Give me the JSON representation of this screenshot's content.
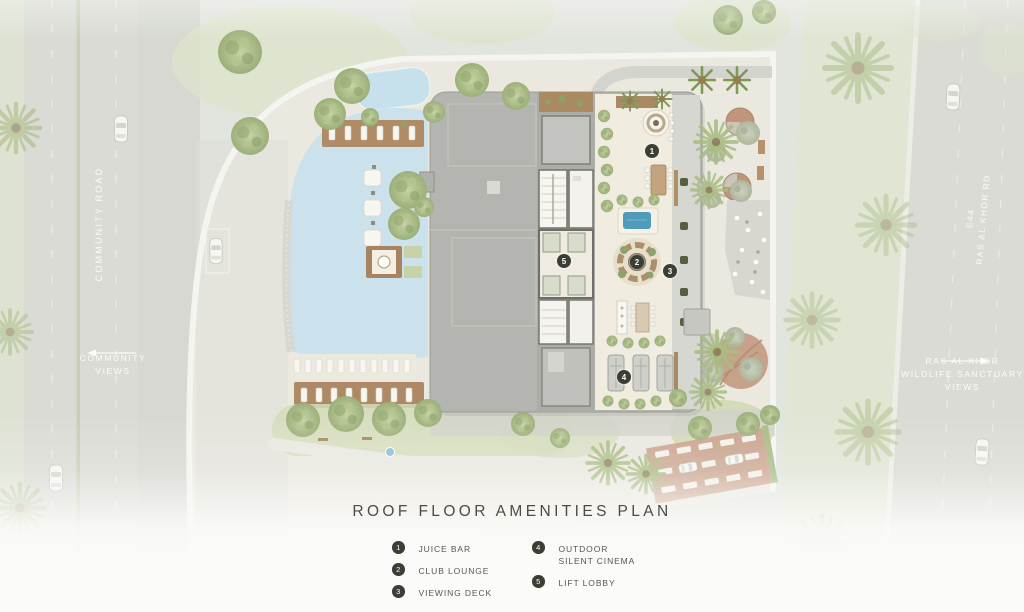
{
  "plan_title": "ROOF FLOOR AMENITIES PLAN",
  "road_labels": {
    "community_road": "COMMUNITY ROAD",
    "community_views": [
      "COMMUNITY",
      "VIEWS"
    ],
    "highway": [
      "E44",
      "RAS AL KHOR RD"
    ],
    "sanctuary_views": [
      "RAS AL KHOR",
      "WILDLIFE SANCTUARY",
      "VIEWS"
    ]
  },
  "markers": [
    {
      "number": "1"
    },
    {
      "number": "2"
    },
    {
      "number": "3"
    },
    {
      "number": "4"
    },
    {
      "number": "5"
    }
  ],
  "legend": {
    "items": [
      {
        "number": "1",
        "label": "JUICE BAR"
      },
      {
        "number": "2",
        "label": "CLUB LOUNGE"
      },
      {
        "number": "3",
        "label": "VIEWING DECK"
      },
      {
        "number": "4",
        "label": "OUTDOOR SILENT CINEMA"
      },
      {
        "number": "5",
        "label": "LIFT LOBBY"
      }
    ]
  },
  "colors": {
    "background": "#e2e4de",
    "road": "#d9dbd4",
    "site": "#edebe2",
    "water": "#cbe1eb",
    "plunge_pool": "#4f9cba",
    "building_roof": "#b4b5b1",
    "terrace": "#f0ece0",
    "wood_deck": "#ae8965",
    "greenery": "#a8ba85",
    "parking": "#c8a089",
    "marker": "#3a3e34",
    "title_text": "#4d4c44"
  }
}
